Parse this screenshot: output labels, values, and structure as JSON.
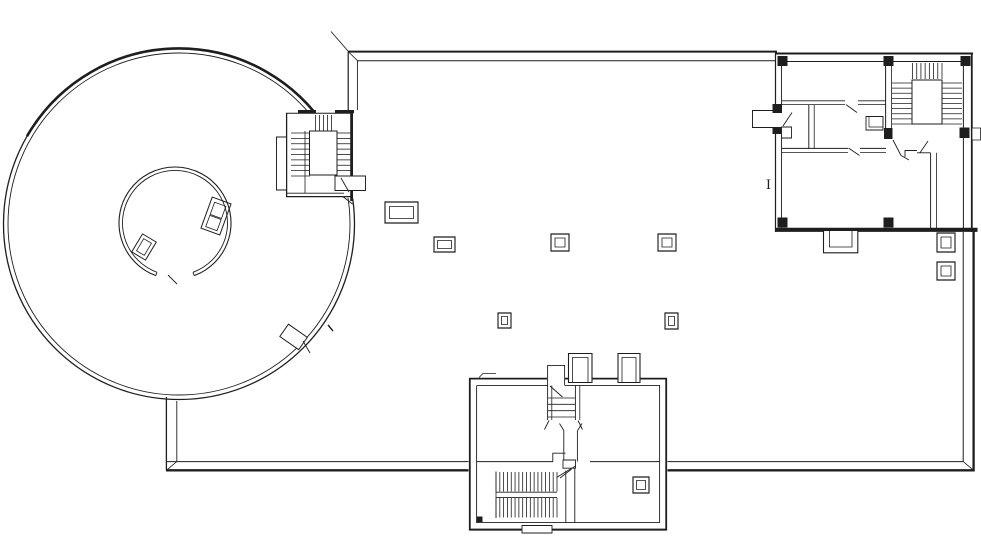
{
  "document": {
    "type": "architectural-floor-plan",
    "description": "CAD floor plan: circular rotunda with inner drum, large open hall, northeast room wing with stair, south entry wing with stair, freestanding columns"
  },
  "annotation": {
    "grid_label": "I"
  },
  "colors": {
    "line": "#1e1e1e",
    "background": "#ffffff"
  },
  "columns": [
    {
      "x": 385,
      "y": 202,
      "w": 33,
      "h": 21,
      "i": 4.5
    },
    {
      "x": 434,
      "y": 237,
      "w": 21,
      "h": 15,
      "i": 3.5
    },
    {
      "x": 551,
      "y": 234,
      "w": 18,
      "h": 17,
      "i": 4
    },
    {
      "x": 658,
      "y": 234,
      "w": 18,
      "h": 17,
      "i": 4
    },
    {
      "x": 498,
      "y": 313,
      "w": 13,
      "h": 15,
      "i": 3.5
    },
    {
      "x": 665,
      "y": 313,
      "w": 13,
      "h": 16,
      "i": 3.5
    },
    {
      "x": 937,
      "y": 233,
      "w": 18,
      "h": 19,
      "i": 4
    },
    {
      "x": 937,
      "y": 262,
      "w": 18,
      "h": 18,
      "i": 4
    },
    {
      "x": 633,
      "y": 477,
      "w": 16,
      "h": 16,
      "i": 3.5
    }
  ],
  "stairs": [
    {
      "name": "west-top",
      "x": 315.5,
      "y": 115,
      "w": 16,
      "h": 16,
      "dir": "v",
      "n": 5
    },
    {
      "name": "west-left",
      "x": 291,
      "y": 133,
      "w": 19,
      "h": 43,
      "dir": "h",
      "n": 9
    },
    {
      "name": "west-right",
      "x": 337,
      "y": 133,
      "w": 13.5,
      "h": 43,
      "dir": "h",
      "n": 9
    },
    {
      "name": "ne-top",
      "x": 912.5,
      "y": 63,
      "w": 29.5,
      "h": 16,
      "dir": "v",
      "n": 8
    },
    {
      "name": "ne-left",
      "x": 892,
      "y": 83,
      "w": 20,
      "h": 41,
      "dir": "h",
      "n": 9
    },
    {
      "name": "ne-right",
      "x": 942,
      "y": 83,
      "w": 20,
      "h": 41,
      "dir": "h",
      "n": 9
    },
    {
      "name": "s-upper",
      "x": 496,
      "y": 472,
      "w": 61,
      "h": 19.5,
      "dir": "v",
      "n": 17
    },
    {
      "name": "s-lower",
      "x": 496,
      "y": 498,
      "w": 61,
      "h": 19.5,
      "dir": "v",
      "n": 17
    },
    {
      "name": "s-steps",
      "x": 548,
      "y": 398,
      "w": 27.5,
      "h": 19,
      "dir": "h",
      "n": 4
    }
  ]
}
